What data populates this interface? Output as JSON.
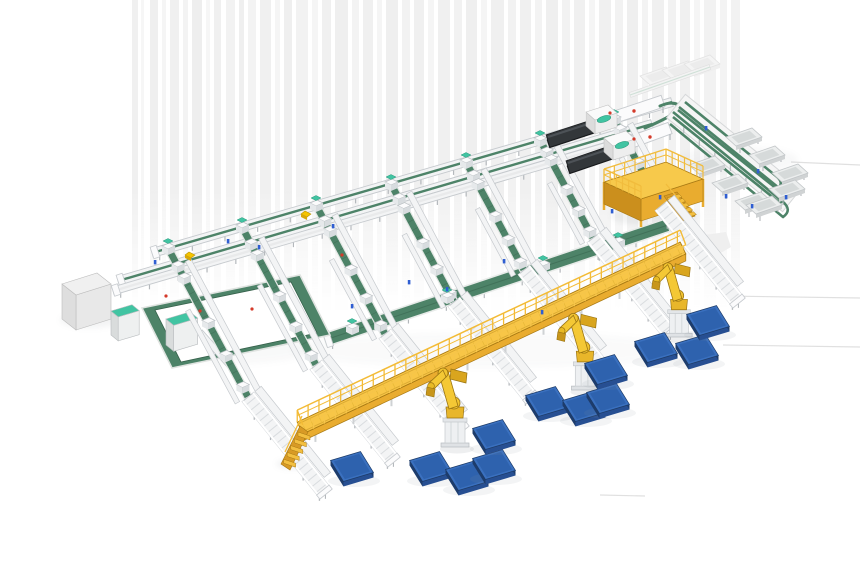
{
  "meta": {
    "label": "Isometric 3D render of an automated parcel sorting and palletizing facility"
  },
  "palette": {
    "green": "#4d8368",
    "greenDark": "#36614b",
    "greenLite": "#a4c5b2",
    "mint": "#41c4a2",
    "mintDark": "#2d9b7d",
    "railStroke": "#c6cace",
    "convFill": "#f3f4f5",
    "slat": "#d9dcdf",
    "leg": "#b4b8bc",
    "white": "#fbfbfc",
    "yellow": "#f8c647",
    "yellowMid": "#e9ac2f",
    "yellowDark": "#cb8f1d",
    "yellowStroke": "#a97a14",
    "robotYellow": "#f2c430",
    "robotShade": "#c8961b",
    "robotStroke": "#9a7412",
    "blueTop": "#3a70bf",
    "blueInner": "#2e62ae",
    "blueFront": "#274f92",
    "blueSide": "#1d3c6c",
    "blueRim": "#1c3a66",
    "darkBody": "#33373a",
    "darkSide": "#1e2022",
    "darkRidge": "#4d5257",
    "boxTop": "#f0f0f0",
    "boxFront": "#e8e8e8",
    "boxSide": "#d6d6d6",
    "boxStroke": "#bdbdbd",
    "stationFront": "#e6e9eb",
    "stationSide": "#d8dcdf",
    "stationStroke": "#b9bec2",
    "streak": "#e2e2e2",
    "hline": "#dddddd",
    "sensorBlue": "#2f5ed2",
    "dotRed": "#d43a2a",
    "pkgYellow": "#f5c400",
    "shadow": "#8e9499"
  },
  "scene": {
    "streaks": [
      [
        132,
        6,
        0.5
      ],
      [
        141,
        3,
        0.3
      ],
      [
        150,
        8,
        0.55
      ],
      [
        162,
        4,
        0.35
      ],
      [
        170,
        9,
        0.5
      ],
      [
        183,
        5,
        0.4
      ],
      [
        192,
        10,
        0.6
      ],
      [
        206,
        4,
        0.3
      ],
      [
        214,
        7,
        0.5
      ],
      [
        226,
        9,
        0.45
      ],
      [
        239,
        5,
        0.55
      ],
      [
        248,
        8,
        0.4
      ],
      [
        260,
        11,
        0.5
      ],
      [
        275,
        5,
        0.35
      ],
      [
        284,
        8,
        0.55
      ],
      [
        296,
        12,
        0.45
      ],
      [
        312,
        6,
        0.35
      ],
      [
        322,
        9,
        0.5
      ],
      [
        335,
        13,
        0.55
      ],
      [
        352,
        7,
        0.4
      ],
      [
        363,
        10,
        0.5
      ],
      [
        377,
        5,
        0.35
      ],
      [
        386,
        12,
        0.55
      ],
      [
        402,
        8,
        0.45
      ],
      [
        414,
        10,
        0.5
      ],
      [
        428,
        6,
        0.35
      ],
      [
        438,
        12,
        0.5
      ],
      [
        454,
        8,
        0.45
      ],
      [
        466,
        11,
        0.55
      ],
      [
        481,
        6,
        0.35
      ],
      [
        491,
        13,
        0.5
      ],
      [
        508,
        8,
        0.45
      ],
      [
        520,
        11,
        0.5
      ],
      [
        535,
        7,
        0.4
      ],
      [
        546,
        12,
        0.55
      ],
      [
        562,
        8,
        0.45
      ],
      [
        574,
        11,
        0.5
      ],
      [
        589,
        6,
        0.35
      ],
      [
        599,
        12,
        0.5
      ],
      [
        615,
        8,
        0.45
      ],
      [
        627,
        11,
        0.55
      ],
      [
        642,
        6,
        0.4
      ],
      [
        652,
        12,
        0.5
      ],
      [
        668,
        8,
        0.45
      ],
      [
        680,
        10,
        0.5
      ],
      [
        694,
        6,
        0.35
      ],
      [
        704,
        12,
        0.45
      ],
      [
        720,
        7,
        0.4
      ],
      [
        731,
        9,
        0.45
      ]
    ],
    "streakBand": {
      "y0": 0,
      "y1": 310,
      "fadeFrom": 190
    },
    "hlines": [
      [
        791,
        162,
        860,
        165
      ],
      [
        723,
        296,
        860,
        298
      ],
      [
        723,
        345,
        860,
        347
      ],
      [
        600,
        495,
        645,
        496
      ]
    ],
    "softShadows": [
      {
        "cx": 90,
        "cy": 320,
        "rx": 30,
        "ry": 8,
        "o": 0.1
      },
      {
        "cx": 240,
        "cy": 348,
        "rx": 72,
        "ry": 16,
        "o": 0.05
      },
      {
        "cx": 655,
        "cy": 216,
        "rx": 44,
        "ry": 10,
        "o": 0.12
      },
      {
        "cx": 293,
        "cy": 464,
        "rx": 17,
        "ry": 5,
        "o": 0.12
      },
      {
        "cx": 590,
        "cy": 150,
        "rx": 55,
        "ry": 10,
        "o": 0.07
      },
      {
        "cx": 738,
        "cy": 160,
        "rx": 60,
        "ry": 14,
        "o": 0.06
      },
      {
        "cx": 490,
        "cy": 350,
        "rx": 200,
        "ry": 18,
        "o": 0.04
      }
    ],
    "faintBlob": [
      [
        698,
        236
      ],
      [
        726,
        232
      ],
      [
        731,
        247
      ],
      [
        712,
        258
      ],
      [
        698,
        252
      ]
    ],
    "trunks": [
      {
        "x1": 152,
        "y1": 253,
        "x2": 672,
        "y2": 102,
        "w": 9,
        "green": true,
        "legStep": 34
      },
      {
        "x1": 118,
        "y1": 281,
        "x2": 652,
        "y2": 124,
        "w": 9,
        "green": true,
        "legStep": 34
      },
      {
        "x1": 113,
        "y1": 291,
        "x2": 608,
        "y2": 146,
        "w": 8,
        "green": false,
        "legStep": 30
      },
      {
        "x1": 325,
        "y1": 340,
        "x2": 668,
        "y2": 225,
        "w": 13,
        "green": true,
        "wide": true,
        "legStep": 40
      }
    ],
    "trunkTables": [
      {
        "x1": 600,
        "y1": 122,
        "x2": 663,
        "y2": 101,
        "w": 12
      },
      {
        "x1": 615,
        "y1": 148,
        "x2": 670,
        "y2": 128,
        "w": 12
      }
    ],
    "cornerCurves": [
      "M660,106 Q676,99 682,109",
      "M645,128 Q668,118 676,112"
    ],
    "branches": [
      {
        "gx1": 168,
        "gy1": 248,
        "gx2": 248,
        "gy2": 397,
        "sx2": 326,
        "sy2": 494
      },
      {
        "gx1": 242,
        "gy1": 227,
        "gx2": 316,
        "gy2": 365,
        "sx2": 394,
        "sy2": 462
      },
      {
        "gx1": 316,
        "gy1": 205,
        "gx2": 385,
        "gy2": 334,
        "sx2": 463,
        "sy2": 431
      },
      {
        "gx1": 391,
        "gy1": 184,
        "gx2": 454,
        "gy2": 302,
        "sx2": 532,
        "sy2": 399
      },
      {
        "gx1": 466,
        "gy1": 162,
        "gx2": 524,
        "gy2": 270,
        "sx2": 602,
        "sy2": 367
      },
      {
        "gx1": 540,
        "gy1": 140,
        "gx2": 593,
        "gy2": 238,
        "sx2": 671,
        "sy2": 335
      },
      {
        "gx1": 614,
        "gy1": 119,
        "gx2": 661,
        "gy2": 206,
        "sx2": 739,
        "sy2": 303
      }
    ],
    "stationFractions": [
      0.12,
      0.2,
      0.5,
      0.72,
      0.93
    ],
    "extraStations": [
      [
        352,
        328
      ],
      [
        447,
        297
      ],
      [
        543,
        265
      ],
      [
        618,
        242
      ]
    ],
    "loop": {
      "outer": [
        [
          142,
          308
        ],
        [
          300,
          275
        ],
        [
          330,
          335
        ],
        [
          172,
          368
        ]
      ],
      "inner": [
        [
          155,
          310
        ],
        [
          291,
          282
        ],
        [
          317,
          333
        ],
        [
          181,
          362
        ]
      ],
      "stub": {
        "x1": 200,
        "y1": 332,
        "x2": 232,
        "y2": 368,
        "w": 6
      }
    },
    "cabinets": [
      {
        "x": 111,
        "y": 311,
        "ew": 21,
        "ed": 13,
        "h": 24
      },
      {
        "x": 166,
        "y": 319,
        "ew": 24,
        "ed": 14,
        "h": 26
      }
    ],
    "grayBox": {
      "p": [
        62,
        284
      ],
      "E": [
        35,
        -11
      ],
      "D": [
        14,
        11
      ],
      "h": 35
    },
    "machines": [
      {
        "bx1": 548,
        "by1": 141,
        "bx2": 600,
        "by2": 124,
        "headX": 586,
        "headY": 112,
        "tealX": 604,
        "tealY": 119,
        "redX": 634,
        "redY": 111
      },
      {
        "bx1": 568,
        "by1": 167,
        "bx2": 618,
        "by2": 150,
        "headX": 604,
        "headY": 138,
        "tealX": 622,
        "tealY": 145,
        "redX": 650,
        "redY": 137
      }
    ],
    "mezzanine": {
      "top": [
        [
          604,
          182
        ],
        [
          666,
          162
        ],
        [
          703,
          179
        ],
        [
          641,
          199
        ]
      ],
      "h": 22,
      "stairs": {
        "x": 664,
        "y": 196,
        "steps": 5
      },
      "railH": 13
    },
    "walkway": {
      "x1": 300,
      "y1": 428,
      "x2": 683,
      "y2": 248,
      "halfW": 6.5,
      "faceH": 7,
      "railBackH": 12,
      "railFrontH": 9,
      "postStep": 12,
      "legStep": 42,
      "stairX": 300,
      "stairY": 430,
      "stairSteps": 5
    },
    "robots": [
      {
        "gx": 455,
        "gy": 447,
        "s": 1.0
      },
      {
        "gx": 585,
        "gy": 390,
        "s": 0.97
      },
      {
        "gx": 679,
        "gy": 337,
        "s": 0.94
      }
    ],
    "pallets": [
      [
        352,
        469
      ],
      [
        431,
        469
      ],
      [
        467,
        478
      ],
      [
        494,
        467
      ],
      [
        494,
        437
      ],
      [
        547,
        404
      ],
      [
        584,
        409
      ],
      [
        608,
        401
      ],
      [
        606,
        372
      ],
      [
        656,
        350
      ],
      [
        697,
        352
      ],
      [
        708,
        323
      ]
    ],
    "laneBase": {
      "x1": 676,
      "y1": 106,
      "x2": 792,
      "y2": 200,
      "w": 30
    },
    "lanePaths": [
      "M673,112 L782,201 Q793,210 783,217 L670,124",
      "M679,107 L779,188 Q789,196 780,203 L673,117",
      "M685,102 L776,176 Q785,183 777,189 L678,110"
    ],
    "trays": [
      [
        744,
        137
      ],
      [
        767,
        155
      ],
      [
        790,
        173
      ],
      [
        707,
        165
      ],
      [
        730,
        183
      ],
      [
        753,
        201
      ],
      [
        764,
        205
      ],
      [
        787,
        189
      ]
    ],
    "ghostTrays": [
      [
        658,
        76
      ],
      [
        680,
        70
      ],
      [
        702,
        64
      ]
    ],
    "miniRail": {
      "x1": 630,
      "y1": 95,
      "x2": 710,
      "y2": 67
    },
    "yellowBoxes": [
      [
        190,
        256
      ],
      [
        306,
        215
      ]
    ],
    "blueDots": [
      [
        155,
        262
      ],
      [
        228,
        241
      ],
      [
        259,
        247
      ],
      [
        333,
        226
      ],
      [
        352,
        306
      ],
      [
        409,
        282
      ],
      [
        447,
        289
      ],
      [
        504,
        261
      ],
      [
        542,
        312
      ],
      [
        612,
        211
      ],
      [
        660,
        197
      ],
      [
        706,
        128
      ],
      [
        758,
        171
      ],
      [
        786,
        197
      ],
      [
        726,
        196
      ],
      [
        752,
        206
      ]
    ],
    "redDots": [
      [
        166,
        296
      ],
      [
        200,
        311
      ],
      [
        252,
        309
      ],
      [
        610,
        113
      ],
      [
        634,
        139
      ],
      [
        342,
        255
      ]
    ]
  }
}
